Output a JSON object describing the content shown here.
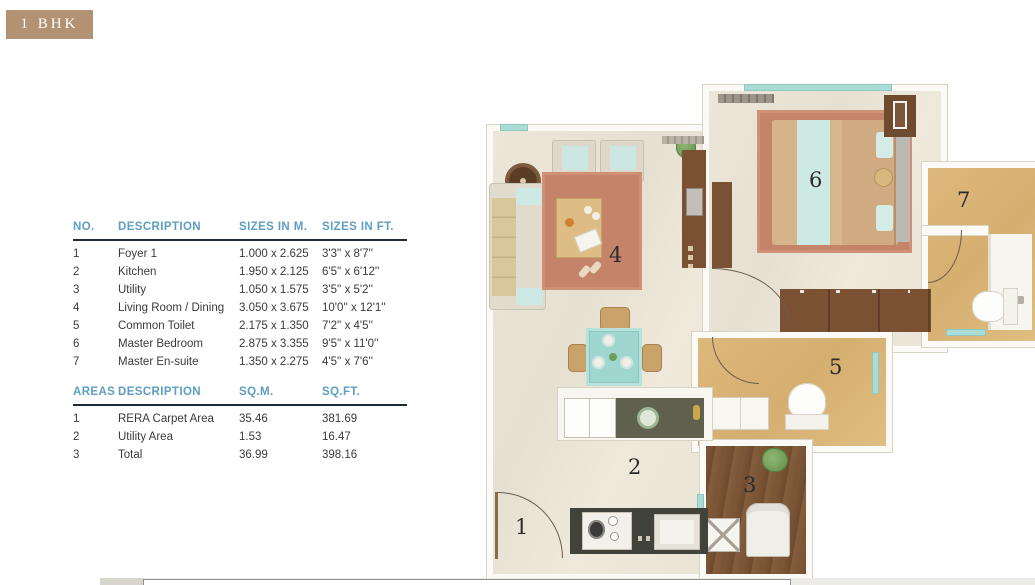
{
  "badge": {
    "label": "1 BHK"
  },
  "dimensions_table": {
    "headers": [
      "NO.",
      "DESCRIPTION",
      "SIZES IN M.",
      "SIZES IN FT."
    ],
    "rows": [
      {
        "no": "1",
        "description": "Foyer 1",
        "size_m": "1.000 x 2.625",
        "size_ft": "3'3'' x 8'7''"
      },
      {
        "no": "2",
        "description": "Kitchen",
        "size_m": "1.950 x 2.125",
        "size_ft": "6'5'' x  6'12''"
      },
      {
        "no": "3",
        "description": "Utility",
        "size_m": "1.050 x 1.575",
        "size_ft": "3'5'' x  5'2''"
      },
      {
        "no": "4",
        "description": "Living Room / Dining",
        "size_m": "3.050 x 3.675",
        "size_ft": "10'0'' x 12'1''"
      },
      {
        "no": "5",
        "description": "Common Toilet",
        "size_m": "2.175 x 1.350",
        "size_ft": "7'2'' x  4'5''"
      },
      {
        "no": "6",
        "description": "Master Bedroom",
        "size_m": "2.875 x 3.355",
        "size_ft": "9'5'' x  11'0''"
      },
      {
        "no": "7",
        "description": "Master En-suite",
        "size_m": "1.350 x 2.275",
        "size_ft": "4'5'' x 7'6''"
      }
    ]
  },
  "areas_table": {
    "headers": [
      "AREAS",
      "DESCRIPTION",
      "SQ.M.",
      "SQ.FT."
    ],
    "rows": [
      {
        "no": "1",
        "description": "RERA Carpet Area",
        "sqm": "35.46",
        "sqft": "381.69"
      },
      {
        "no": "2",
        "description": "Utility Area",
        "sqm": "1.53",
        "sqft": "16.47"
      },
      {
        "no": "3",
        "description": "Total",
        "sqm": "36.99",
        "sqft": "398.16"
      }
    ]
  },
  "floorplan": {
    "rooms": [
      {
        "number": "1",
        "name": "Foyer 1"
      },
      {
        "number": "2",
        "name": "Kitchen"
      },
      {
        "number": "3",
        "name": "Utility"
      },
      {
        "number": "4",
        "name": "Living Room / Dining"
      },
      {
        "number": "5",
        "name": "Common Toilet"
      },
      {
        "number": "6",
        "name": "Master Bedroom"
      },
      {
        "number": "7",
        "name": "Master En-suite"
      }
    ]
  },
  "colors": {
    "badge-tan": "#b29272",
    "header-blue": "#5d9ec2",
    "underline-dark": "#1e2a36",
    "body-text": "#3a3a3a",
    "wall-white": "#fbfaf6",
    "floor-cream": "#eae4d7",
    "floor-tan": "#d9b377",
    "floor-wood": "#7a5637",
    "rug-terracotta": "#c5836a",
    "accent-teal": "#a9dcd5",
    "furniture-brown": "#7b5133",
    "counter-dark": "#54564a"
  }
}
